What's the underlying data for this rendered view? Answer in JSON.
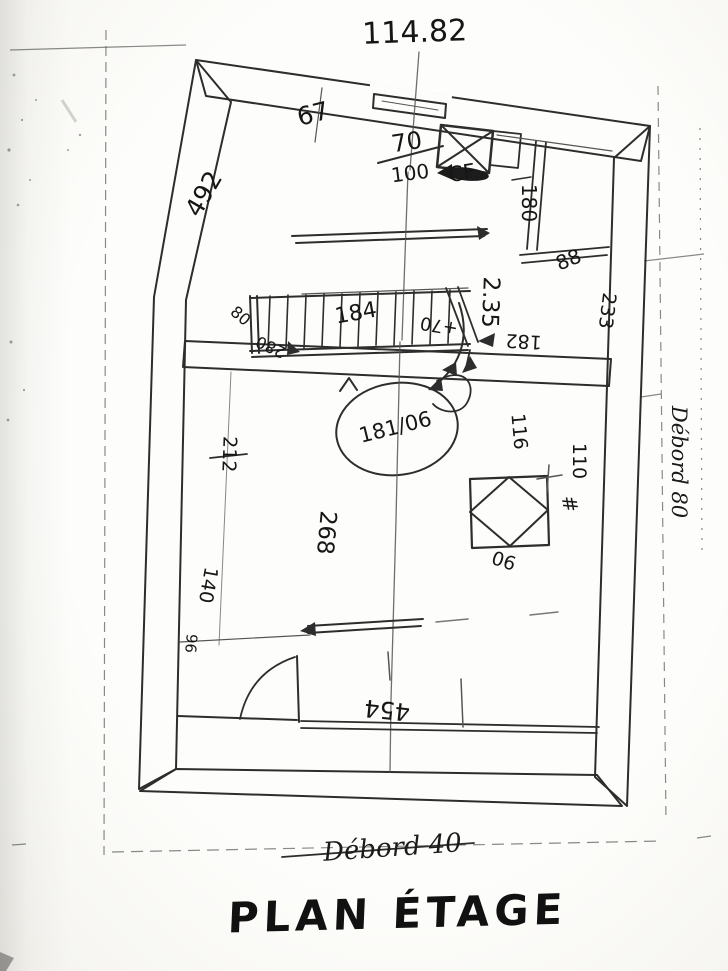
{
  "sketch": {
    "title": "PLAN ÉTAGE",
    "elevation_mark": "114.82",
    "bottom_note": "Débord 40",
    "right_note": "Débord 80",
    "flue_label": "CF",
    "circled_note": "181/06",
    "hash_mark": "#",
    "ink_color": "#2d2d2d",
    "dims": {
      "d67": "67",
      "d70": "70",
      "d100": "100",
      "d180": "180",
      "d88": "88",
      "d492": "492",
      "d80": "80",
      "d280": "280",
      "d184": "184",
      "p70": "+70",
      "d235": "2.35",
      "d182": "182",
      "d233": "233",
      "d116": "116",
      "d110": "110",
      "d90": "90",
      "d268": "268",
      "d212": "212",
      "d140": "140",
      "d96": "96",
      "d454": "454"
    }
  }
}
